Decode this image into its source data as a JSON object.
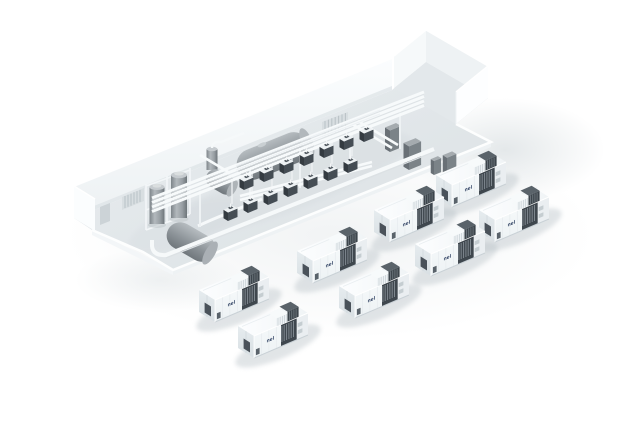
{
  "scene": {
    "description": "Isometric 3D rendering of a hydrogen electrolyser plant: an indoor process hall with storage tanks, overhead piping and equipment skids, and eight containerized electrolyser units arranged outside",
    "container_count": 8
  },
  "branding": {
    "container_logo": "nel",
    "logo_color": "#1d3054"
  },
  "palette": {
    "background": "#ffffff",
    "wall_white": "#f7fafb",
    "floor_gray": "#e2e7ea",
    "tank_gray": "#8d9499",
    "equipment_dark": "#434b52",
    "container_shell": "#f3f7f8",
    "pipe_white": "#f8fafb",
    "shadow_soft": "#cdd4d8"
  }
}
